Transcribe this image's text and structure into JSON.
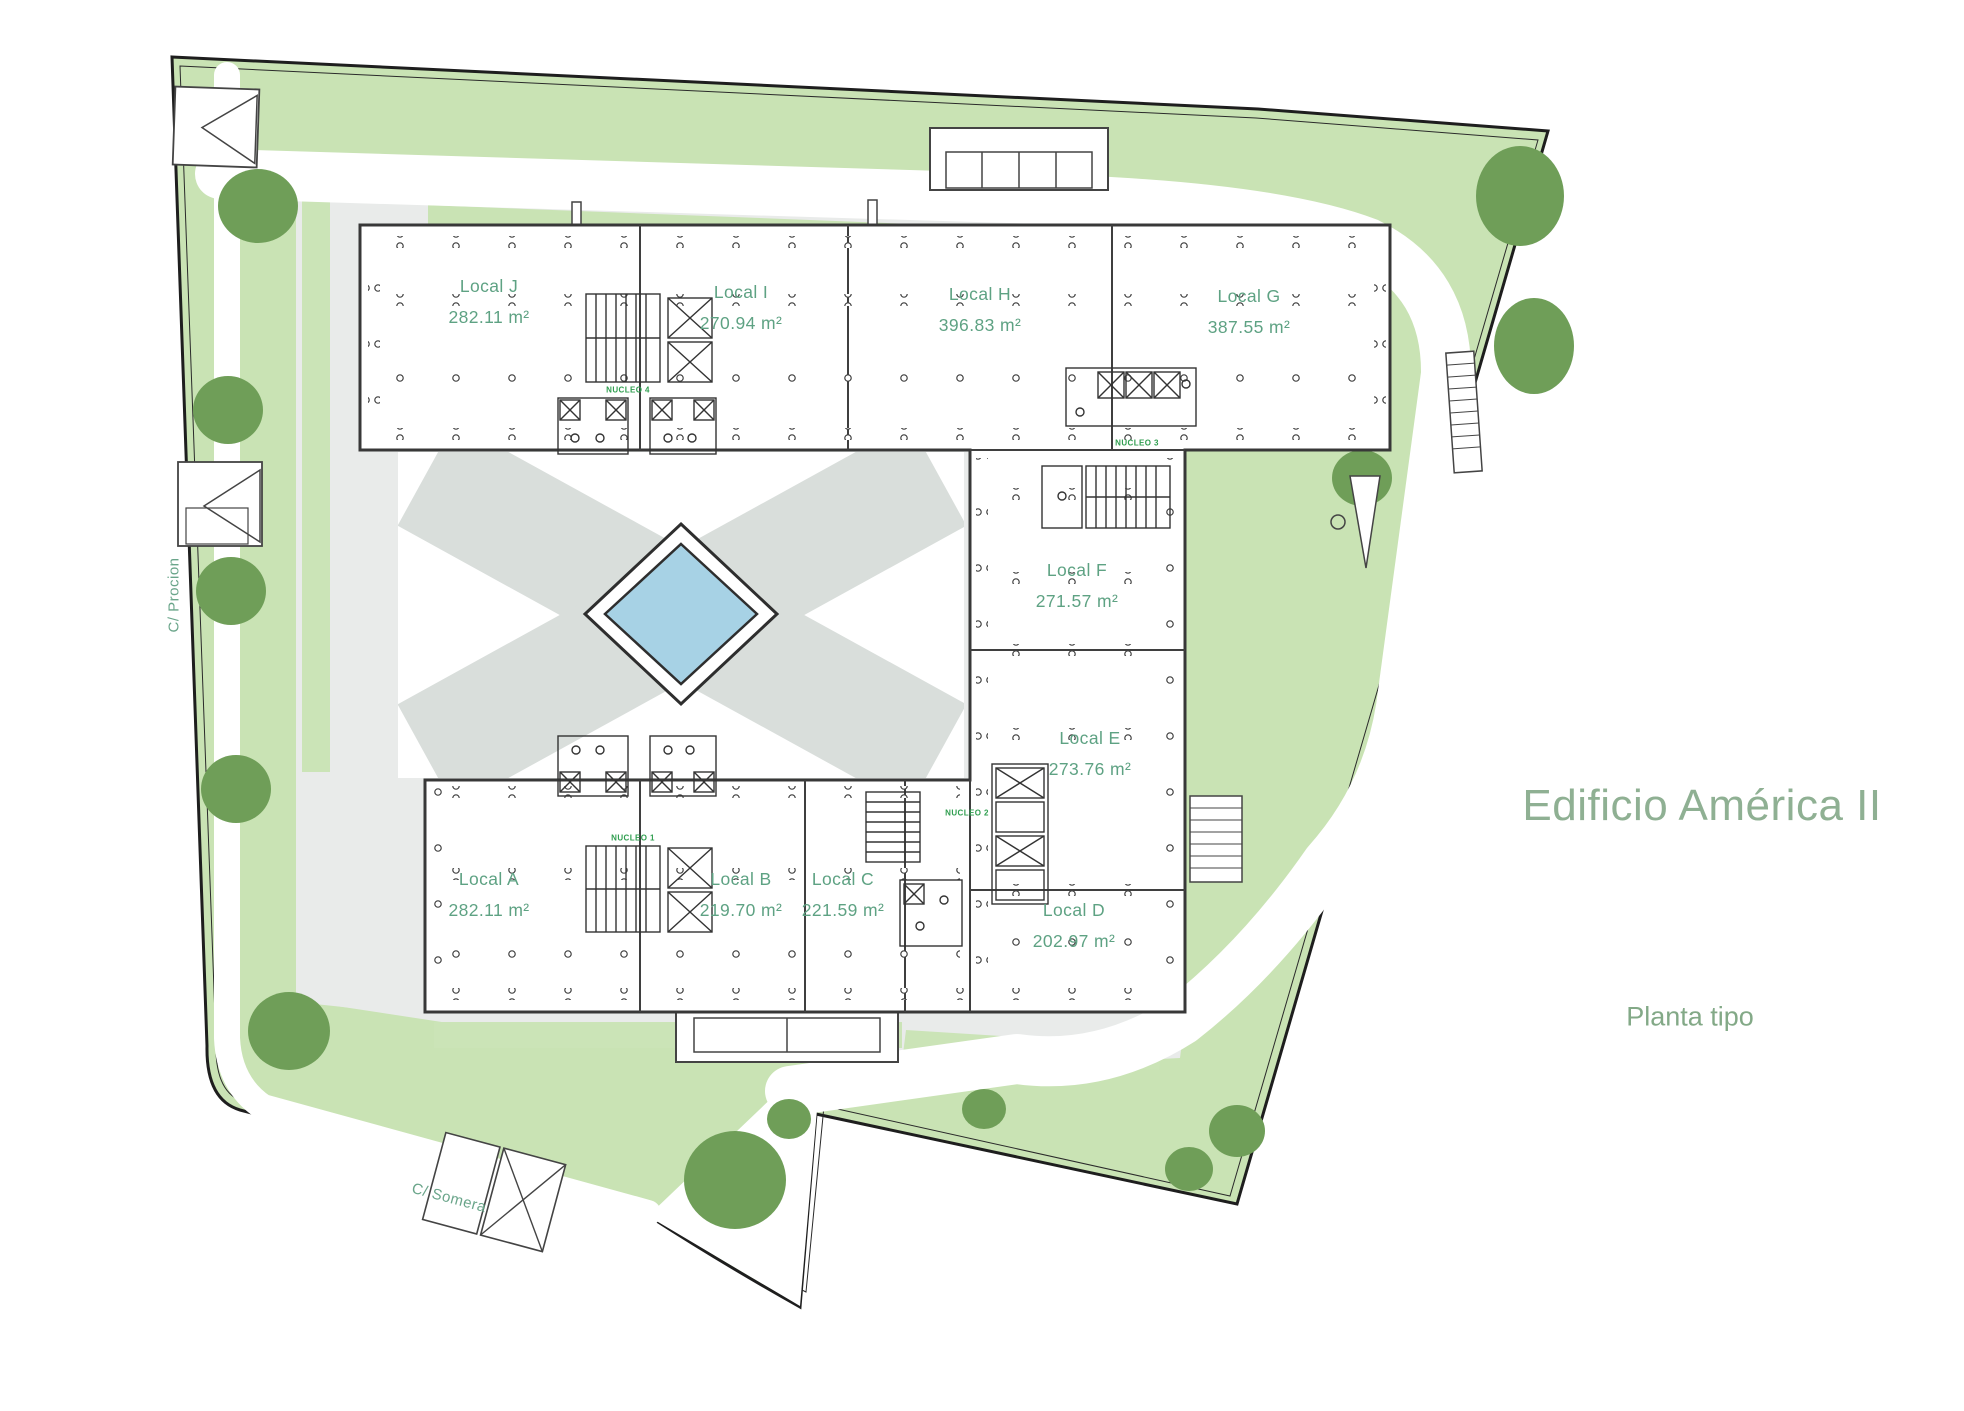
{
  "title": "Edificio América II",
  "subtitle": "Planta tipo",
  "streets": {
    "left": "C/ Procion",
    "bottom": "C/ Somera"
  },
  "units": {
    "j": {
      "name": "Local J",
      "area": "282.11 m²"
    },
    "i": {
      "name": "Local I",
      "area": "270.94 m²"
    },
    "h": {
      "name": "Local H",
      "area": "396.83 m²"
    },
    "g": {
      "name": "Local G",
      "area": "387.55 m²"
    },
    "f": {
      "name": "Local F",
      "area": "271.57 m²"
    },
    "e": {
      "name": "Local E",
      "area": "273.76 m²"
    },
    "a": {
      "name": "Local A",
      "area": "282.11 m²"
    },
    "b": {
      "name": "Local B",
      "area": "219.70 m²"
    },
    "c": {
      "name": "Local C",
      "area": "221.59 m²"
    },
    "d": {
      "name": "Local D",
      "area": "202.97 m²"
    }
  },
  "cores": {
    "n1": "NUCLEO 1",
    "n2": "NUCLEO 2",
    "n3": "NUCLEO 3",
    "n4": "NUCLEO 4"
  },
  "colors": {
    "site_green": "#c9e3b4",
    "inner_green": "#cbe4b7",
    "tree_green": "#6f9e58",
    "paving_gray": "#e9ebea",
    "courtyard_gray": "#d9dedb",
    "pool_blue": "#a7d2e5",
    "label_green": "#5ea283",
    "title_green": "#8fb093",
    "nucleo_green": "#2f9e4f"
  }
}
